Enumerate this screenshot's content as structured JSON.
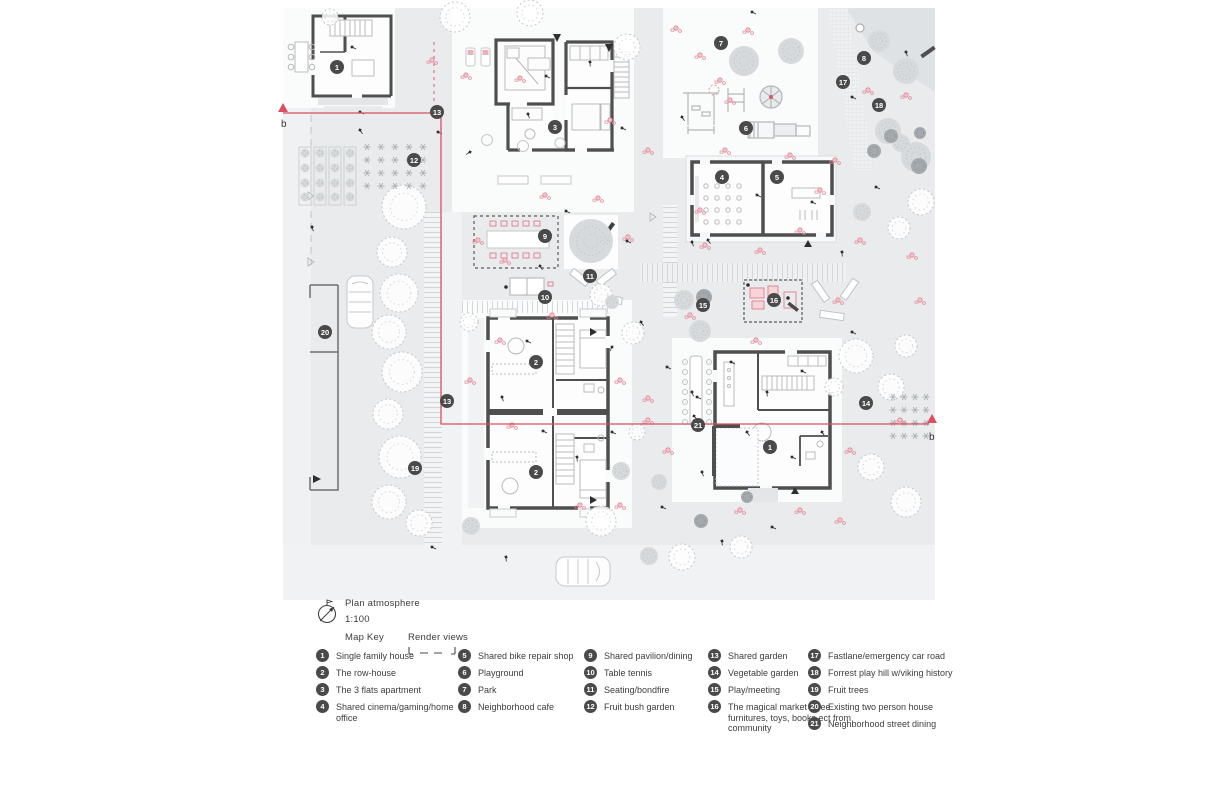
{
  "plan_header": {
    "title": "Plan atmosphere",
    "scale": "1:100",
    "map_key_label": "Map Key",
    "render_views_label": "Render views"
  },
  "section_label": "b",
  "legend": {
    "columns": [
      [
        {
          "n": "1",
          "label": "Single family house"
        },
        {
          "n": "2",
          "label": "The row-house"
        },
        {
          "n": "3",
          "label": "The 3 flats apartment"
        },
        {
          "n": "4",
          "label": "Shared cinema/gaming/home office"
        }
      ],
      [
        {
          "n": "5",
          "label": "Shared bike repair shop"
        },
        {
          "n": "6",
          "label": "Playground"
        },
        {
          "n": "7",
          "label": "Park"
        },
        {
          "n": "8",
          "label": "Neighborhood cafe"
        }
      ],
      [
        {
          "n": "9",
          "label": "Shared pavilion/dining"
        },
        {
          "n": "10",
          "label": "Table tennis"
        },
        {
          "n": "11",
          "label": "Seating/bondfire"
        },
        {
          "n": "12",
          "label": "Fruit bush garden"
        }
      ],
      [
        {
          "n": "13",
          "label": "Shared garden"
        },
        {
          "n": "14",
          "label": "Vegetable garden"
        },
        {
          "n": "15",
          "label": "Play/meeting"
        },
        {
          "n": "16",
          "label": "The magical market - free furnitures, toys, books ect from community"
        }
      ],
      [
        {
          "n": "17",
          "label": "Fastlane/emergency car road"
        },
        {
          "n": "18",
          "label": "Forrest play hill w/viking history"
        },
        {
          "n": "19",
          "label": "Fruit trees"
        },
        {
          "n": "20",
          "label": "Existing two person house"
        },
        {
          "n": "21",
          "label": "Neighborhood street dining"
        }
      ]
    ]
  },
  "plan_markers": [
    {
      "n": "1",
      "x": 337,
      "y": 67
    },
    {
      "n": "3",
      "x": 555,
      "y": 127
    },
    {
      "n": "7",
      "x": 721,
      "y": 43
    },
    {
      "n": "8",
      "x": 864,
      "y": 58
    },
    {
      "n": "17",
      "x": 843,
      "y": 82
    },
    {
      "n": "18",
      "x": 879,
      "y": 105
    },
    {
      "n": "6",
      "x": 746,
      "y": 128
    },
    {
      "n": "4",
      "x": 722,
      "y": 177
    },
    {
      "n": "5",
      "x": 777,
      "y": 177
    },
    {
      "n": "12",
      "x": 414,
      "y": 160
    },
    {
      "n": "13",
      "x": 437,
      "y": 112
    },
    {
      "n": "9",
      "x": 545,
      "y": 236
    },
    {
      "n": "11",
      "x": 590,
      "y": 276
    },
    {
      "n": "10",
      "x": 545,
      "y": 297
    },
    {
      "n": "15",
      "x": 703,
      "y": 305
    },
    {
      "n": "16",
      "x": 774,
      "y": 300
    },
    {
      "n": "20",
      "x": 325,
      "y": 332
    },
    {
      "n": "2",
      "x": 536,
      "y": 362
    },
    {
      "n": "2",
      "x": 536,
      "y": 472
    },
    {
      "n": "13",
      "x": 447,
      "y": 401
    },
    {
      "n": "14",
      "x": 866,
      "y": 403
    },
    {
      "n": "19",
      "x": 415,
      "y": 468
    },
    {
      "n": "21",
      "x": 698,
      "y": 425
    },
    {
      "n": "1",
      "x": 770,
      "y": 447
    }
  ],
  "colors": {
    "accent_pink": "#d85062",
    "wall_gray": "#4f4f4f",
    "marker_gray": "#4a4a4a",
    "ground_gray": "#e9ebec"
  }
}
